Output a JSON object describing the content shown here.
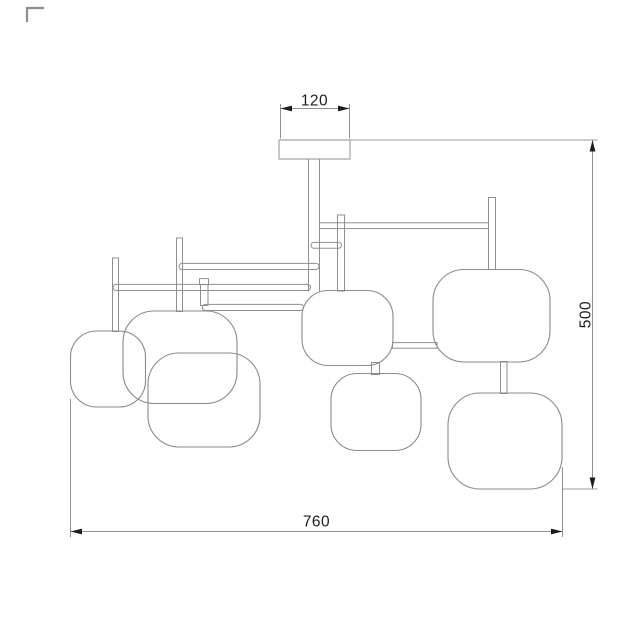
{
  "drawing": {
    "type": "technical dimension drawing",
    "subject": "ceiling chandelier with seven rounded-square shades",
    "dimensions": {
      "canopy_width": "120",
      "height": "500",
      "width": "760"
    },
    "colors": {
      "line": "#8f8f8f",
      "shade_line": "#8a8a8a",
      "text": "#1d1d1d",
      "arrow": "#1c1c1c",
      "background": "#ffffff"
    }
  }
}
